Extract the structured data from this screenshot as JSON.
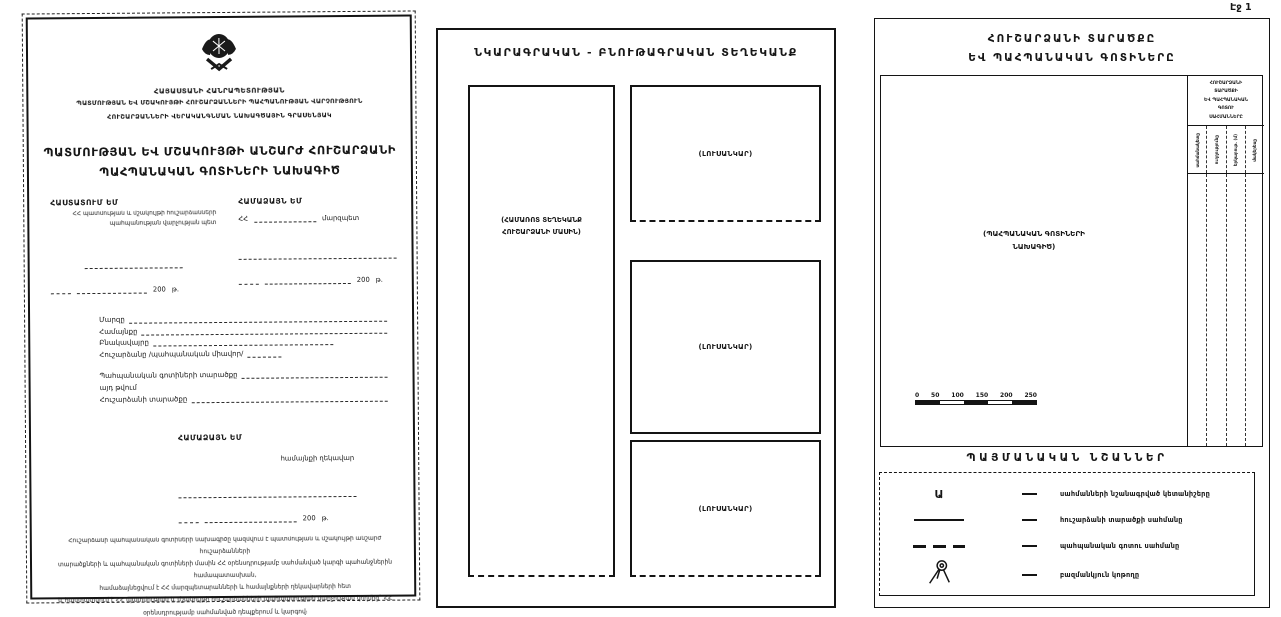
{
  "doc": {
    "year": "200",
    "year_suffix": "թ."
  },
  "page1": {
    "org_lines": [
      "ՀԱՅԱՍՏԱՆԻ ՀԱՆՐԱՊԵՏՈՒԹՅԱՆ",
      "ՊԱՏՄՈՒԹՅԱՆ ԵՎ ՄՇԱԿՈՒՅԹԻ ՀՈՒՇԱՐՁԱՆՆԵՐԻ ՊԱՀՊԱՆՈՒԹՅԱՆ ՎԱՐՉՈՒԹՅՈՒՆ",
      "ՀՈՒՇԱՐՁԱՆՆԵՐԻ ՎԵՐԱԿԱՆԳՆՄԱՆ ՆԱԽԱԳԾԱՅԻՆ ԳՐԱՍԵՆՅԱԿ"
    ],
    "title_lines": [
      "ՊԱՏՄՈՒԹՅԱՆ ԵՎ ՄՇԱԿՈՒՅԹԻ ԱՆՇԱՐԺ ՀՈՒՇԱՐՁԱՆԻ",
      "ՊԱՀՊԱՆԱԿԱՆ ԳՈՏԻՆԵՐԻ ՆԱԽԱԳԻԾ"
    ],
    "approve": {
      "heading": "ՀԱՍՏԱՏՈՒՄ ԵՄ",
      "sub_lines": [
        "ՀՀ պատմության և մշակույթի հուշարձանների",
        "պահպանության վարչության պետ"
      ]
    },
    "agree": {
      "heading": "ՀԱՄԱՁԱՅՆ ԵՄ",
      "prefix": "ՀՀ",
      "role": "մարզպետ"
    },
    "fields": [
      "Մարզը",
      "Համայնքը",
      "Բնակավայրը",
      "Հուշարձանը /պահպանական միավոր/",
      "Պահպանական գոտիների տարածքը",
      "այդ թվում",
      "Հուշարձանի տարածքը"
    ],
    "agree2": {
      "heading": "ՀԱՄԱՁԱՅՆ ԵՄ",
      "role": "համայնքի ղեկավար"
    },
    "footnote_lines": [
      "Հուշարձանի պահպանական գոտիների նախագիծը կազմվում է պատմության և մշակույթի անշարժ հուշարձանների",
      "տարածքների և պահպանական գոտիների մասին ՀՀ օրենսդրությամբ սահմանված կարգի պահանջներին համապատասխան,",
      "համաձայնեցվում է ՀՀ մարզպետարանների և համայնքների ղեկավարների հետ",
      "և հաստատվում է ՀՀ պատմության և մշակույթի հուշարձանների պահպանության վարչության կողմից` ՀՀ",
      "օրենսդրությամբ սահմանված դեպքերում և կարգով։"
    ]
  },
  "page2": {
    "title": "ՆԿԱՐԱԳՐԱԿԱՆ - ԲՆՈՒԹԱԳՐԱԿԱՆ ՏԵՂԵԿԱՆՔ",
    "left_box_lines": [
      "(ՀԱՄԱՌՈՏ ՏԵՂԵԿԱՆՔ",
      "ՀՈՒՇԱՐՁԱՆԻ ՄԱՍԻՆ)"
    ],
    "photo_labels": [
      "(ԼՈՒՍԱՆԿԱՐ)",
      "(ԼՈՒՍԱՆԿԱՐ)",
      "(ԼՈՒՍԱՆԿԱՐ)"
    ]
  },
  "page3": {
    "corner_page_label": "Էջ 1",
    "title_lines": [
      "ՀՈՒՇԱՐՁԱՆԻ ՏԱՐԱԾՔԸ",
      "ԵՎ ՊԱՀՊԱՆԱԿԱՆ ԳՈՏԻՆԵՐԸ"
    ],
    "map_label_lines": [
      "(ՊԱՀՊԱՆԱԿԱՆ ԳՈՏԻՆԵՐԻ",
      "ՆԱԽԱԳԻԾ)"
    ],
    "scale_ticks": [
      "0",
      "50",
      "100",
      "150",
      "200",
      "250"
    ],
    "table": {
      "header_lines": [
        "ՀՈՒՇԱՐՁԱՆԻ",
        "ՏԱՐԱԾՔԻ",
        "ԵՎ ՊԱՀՊԱՆԱԿԱՆ",
        "ԳՈՏՈՒ",
        "ՍԱՀՄԱՆՆԵՐԸ"
      ],
      "columns": [
        "սահմանակետը",
        "ուղղությունը",
        "երկարութ. (մ)",
        "մակերեսը"
      ]
    },
    "legend_title": "ՊԱՅՄԱՆԱԿԱՆ ՆՇԱՆՆԵՐ",
    "legend": [
      {
        "symbol": "Ա",
        "text": "սահմանների նշանագրված կետանիշերը"
      },
      {
        "symbol": "solid-line",
        "text": "հուշարձանի տարածքի սահմանը"
      },
      {
        "symbol": "dashed-line",
        "text": "պահպանական գոտու սահմանը"
      },
      {
        "symbol": "tripod",
        "text": "բազմանկյուն կոթողը"
      }
    ]
  }
}
